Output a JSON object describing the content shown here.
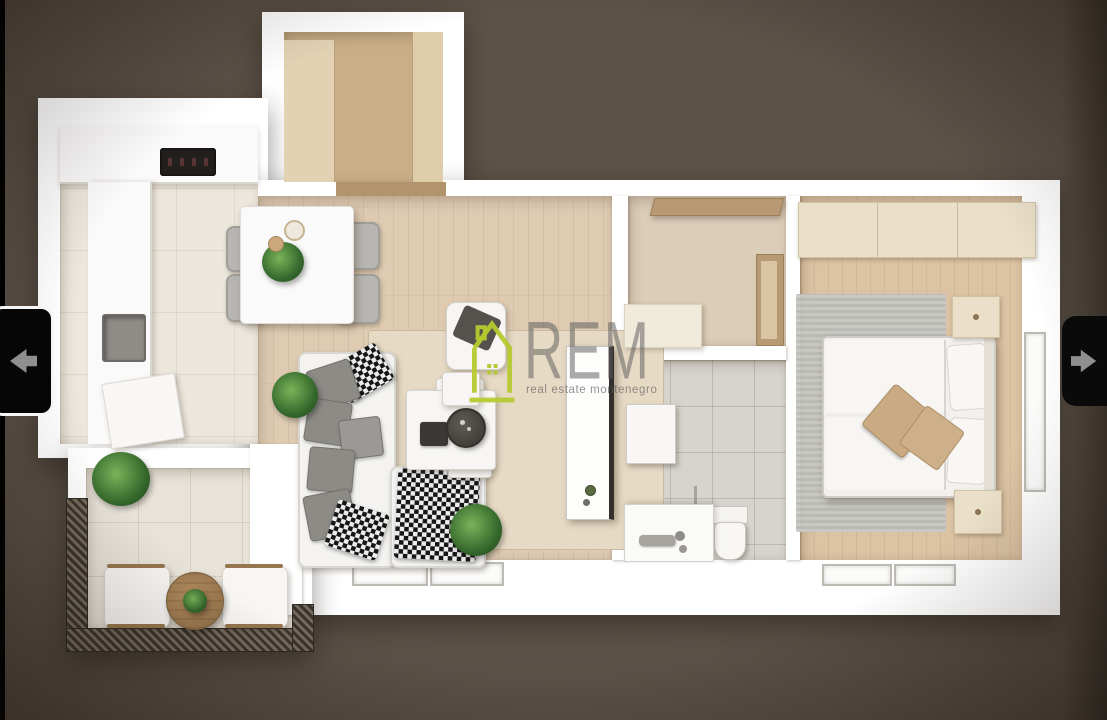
{
  "image_viewer": {
    "background_color": "#5a5047",
    "left_edge_bar_color": "#000000",
    "prev_button": {
      "icon": "arrow-left-icon",
      "icon_color": "#8f8f8f",
      "background": "#060606",
      "border_color": "#f5f5f5"
    },
    "next_button": {
      "icon": "arrow-right-icon",
      "icon_color": "#8f8f8f",
      "background": "#0a0a0a"
    }
  },
  "watermark": {
    "logo_icon": "house-logo-icon",
    "logo_color": "#b5c92f",
    "title": "REM",
    "subtitle": "real estate montenegro",
    "title_color": "rgba(92,92,92,0.52)"
  },
  "floor_plan": {
    "view": "3d-top-down-apartment-render",
    "wall_color": "#ffffff",
    "rooms": [
      {
        "id": "entry-closet",
        "floor_color": "#d9c29e",
        "contents": [
          "wardrobe-panels",
          "door-threshold"
        ]
      },
      {
        "id": "kitchen-dining",
        "floor_color": "#ece7dd",
        "contents": [
          "kitchen-counter",
          "cooktop",
          "sink",
          "dining-table",
          "four-chairs",
          "plant",
          "plates"
        ]
      },
      {
        "id": "living-room",
        "floor_color": "#decbb2",
        "contents": [
          "corner-sofa",
          "gray-cushions",
          "checkered-throw",
          "coffee-table-set",
          "armchair",
          "beige-rug",
          "plants",
          "window",
          "open-door"
        ]
      },
      {
        "id": "hallway",
        "floor_color": "#dccdb9",
        "contents": [
          "wall-shelf",
          "niche",
          "cabinet"
        ]
      },
      {
        "id": "bathroom",
        "floor_color": "#d7d4ce",
        "contents": [
          "vanity-with-faucet",
          "toilet",
          "cabinet",
          "glass-divider"
        ]
      },
      {
        "id": "bedroom",
        "floor_color": "#dcc3a4",
        "contents": [
          "wardrobe",
          "double-bed",
          "pillows",
          "two-nightstands",
          "gray-rug",
          "side-window",
          "bottom-window"
        ]
      },
      {
        "id": "balcony",
        "floor_color": "#e8e3d9",
        "contents": [
          "railing",
          "two-armchairs",
          "round-wood-table",
          "plants"
        ]
      }
    ]
  }
}
